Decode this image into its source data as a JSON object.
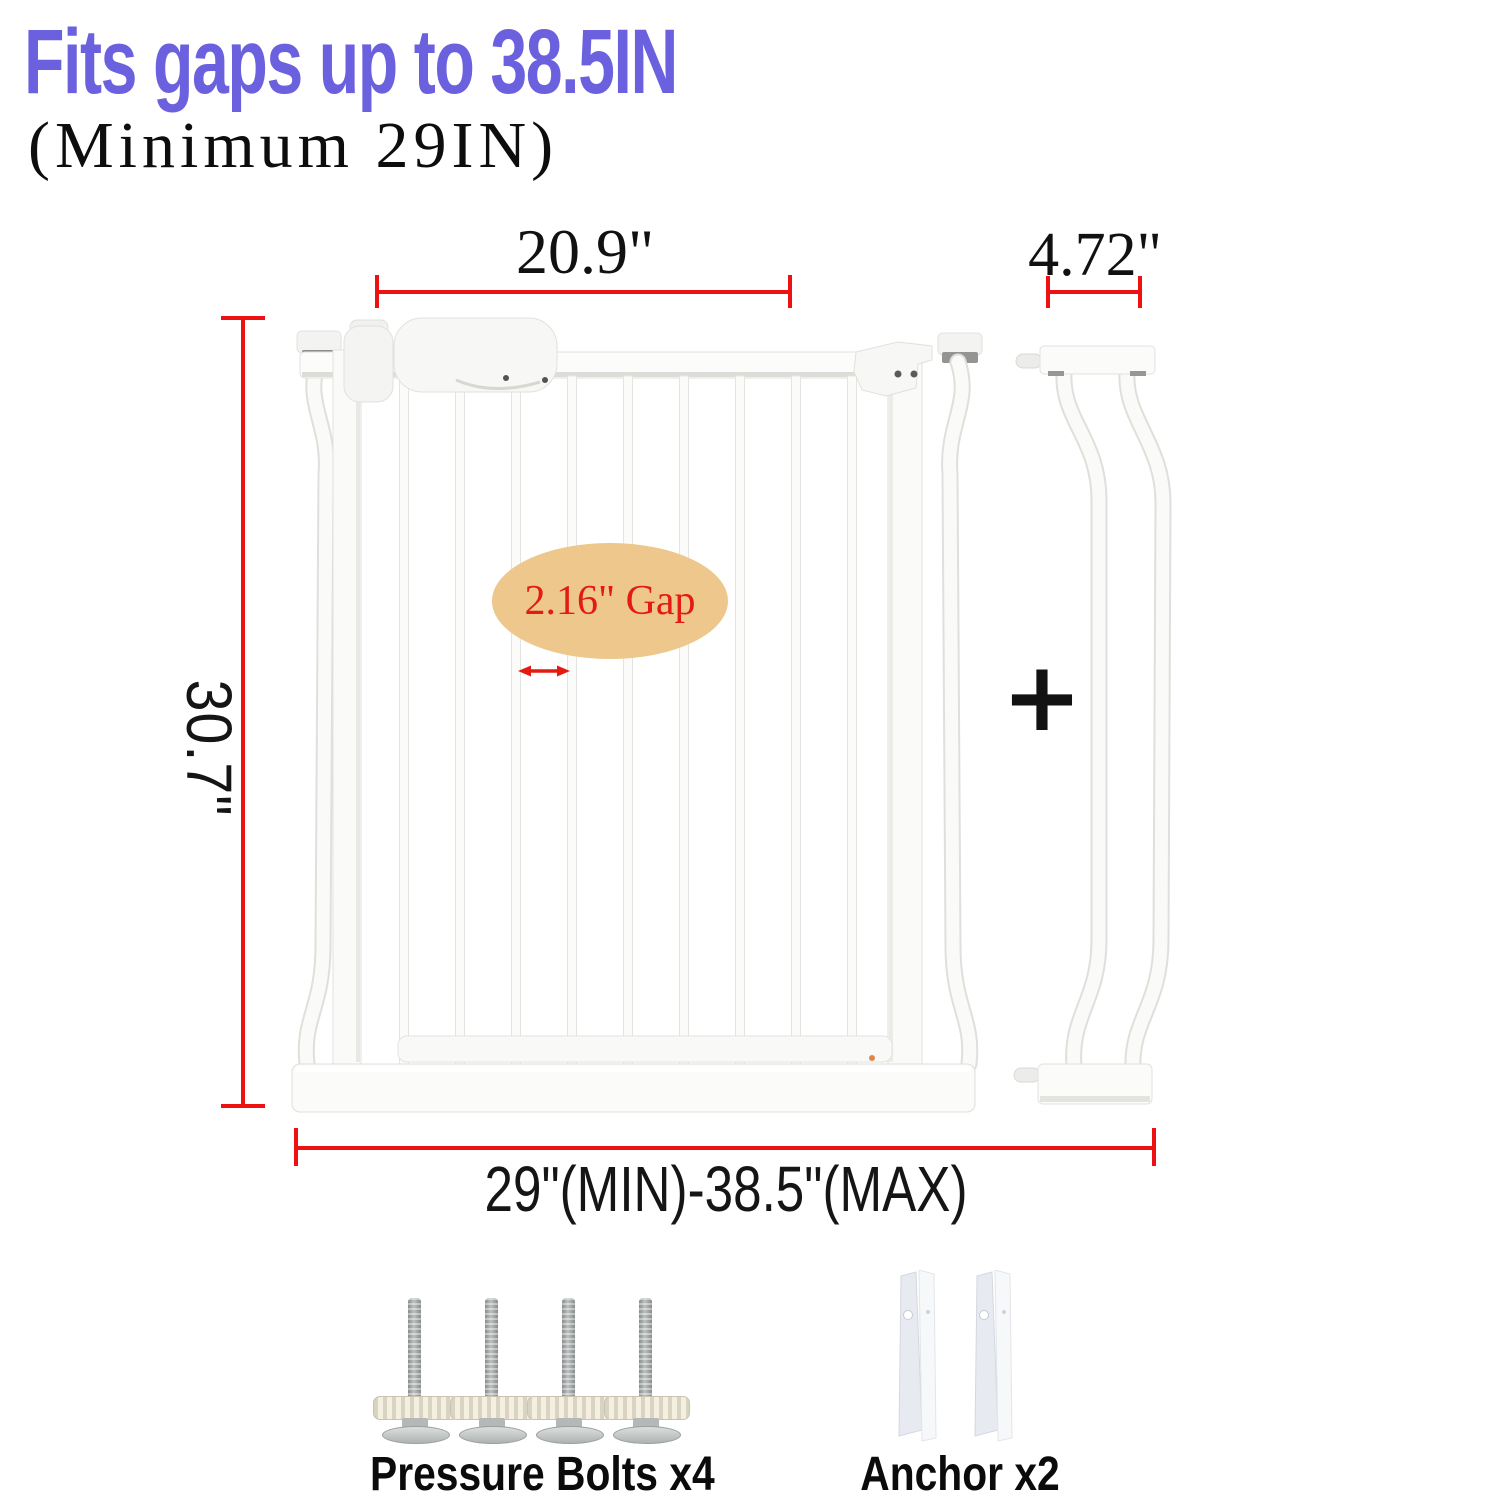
{
  "headline": {
    "title": "Fits gaps up to 38.5IN",
    "subtitle": "(Minimum 29IN)",
    "title_color": "#6b61de"
  },
  "annotations": {
    "gate_width": "20.9\"",
    "extension_width": "4.72\"",
    "gate_height": "30.7\"",
    "fit_range": "29\"(MIN)-38.5\"(MAX)",
    "gap_callout": "2.16\" Gap",
    "plus_symbol": "+",
    "dimension_line_color": "#ee1111",
    "callout_fill": "#eec78c",
    "callout_text_color": "#e41b12"
  },
  "parts_legend": {
    "bolts_label": "Pressure Bolts x4",
    "anchors_label": "Anchor x2"
  }
}
